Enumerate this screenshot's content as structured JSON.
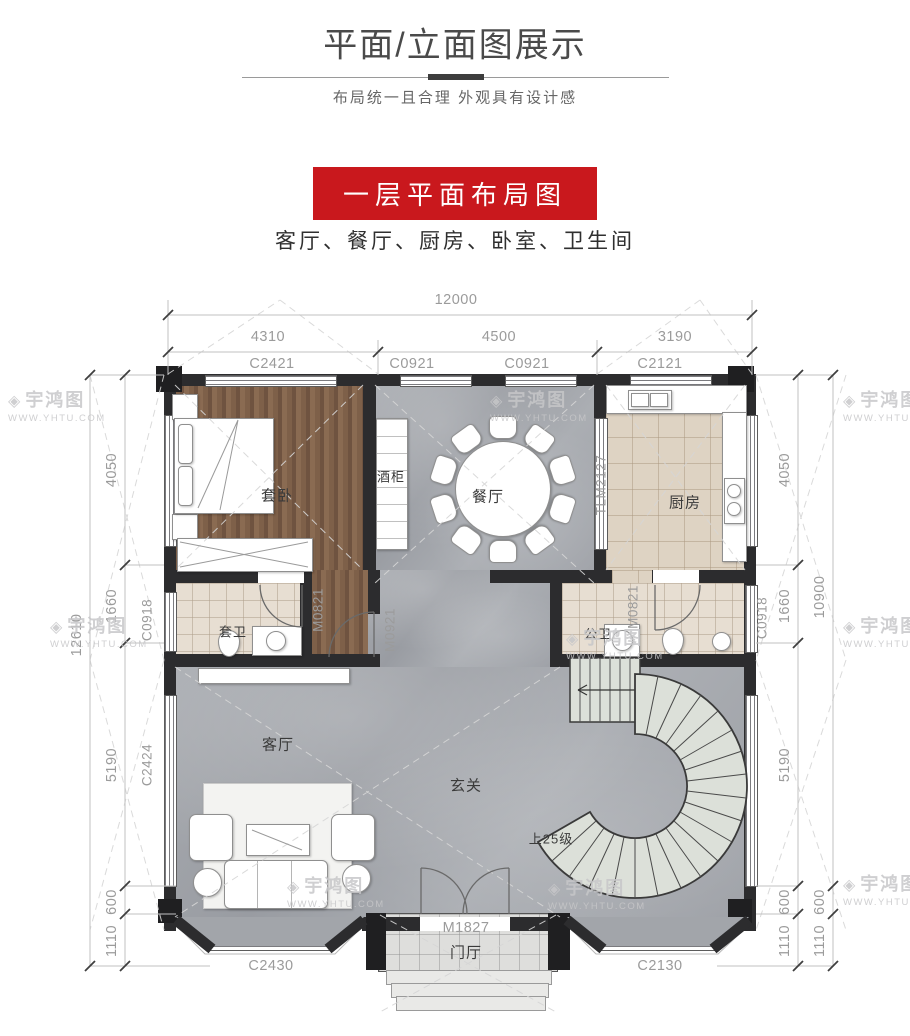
{
  "header": {
    "title": "平面/立面图展示",
    "subtitle": "布局统一且合理  外观具有设计感"
  },
  "section": {
    "badge": "一层平面布局图",
    "rooms_line": "客厅、餐厅、厨房、卧室、卫生间"
  },
  "watermark": {
    "brand": "宇鸿图",
    "logo": "◈",
    "url": "WWW.YHTU.COM"
  },
  "plan": {
    "room_labels": {
      "master": "套卧",
      "wine": "酒柜",
      "dining": "餐厅",
      "kitchen": "厨房",
      "master_bath": "套卫",
      "public_bath": "公卫",
      "living": "客厅",
      "foyer": "玄关",
      "stairs": "上25级",
      "porch": "门厅"
    },
    "door_labels": {
      "master_bath": "M0821",
      "hall": "M0921",
      "public_bath": "M0821",
      "kitchen_slide": "TLM2127",
      "entry": "M1827"
    },
    "window_labels": {
      "top": [
        "C2421",
        "C0921",
        "C0921",
        "C2121"
      ],
      "left_bath": "C0918",
      "left_living": "C2424",
      "right_bath": "C0918",
      "bay_left": "C2430",
      "bay_right": "C2130"
    },
    "dims": {
      "top_total": "12000",
      "top": [
        "4310",
        "4500",
        "3190"
      ],
      "left_total": "12610",
      "left": [
        "4050",
        "1660",
        "5190",
        "600",
        "1110"
      ],
      "right": [
        "4050",
        "1660",
        "5190",
        "600",
        "1110"
      ],
      "right_outer": [
        "10900",
        "600",
        "1110"
      ]
    },
    "colors": {
      "badge_red": "#c9181d",
      "wall": "#2c2c2e",
      "marble": "#a0a3a8",
      "wood": "#7a5c45",
      "tile": "#e3dacd",
      "dim_text": "#9b9b9b"
    }
  }
}
